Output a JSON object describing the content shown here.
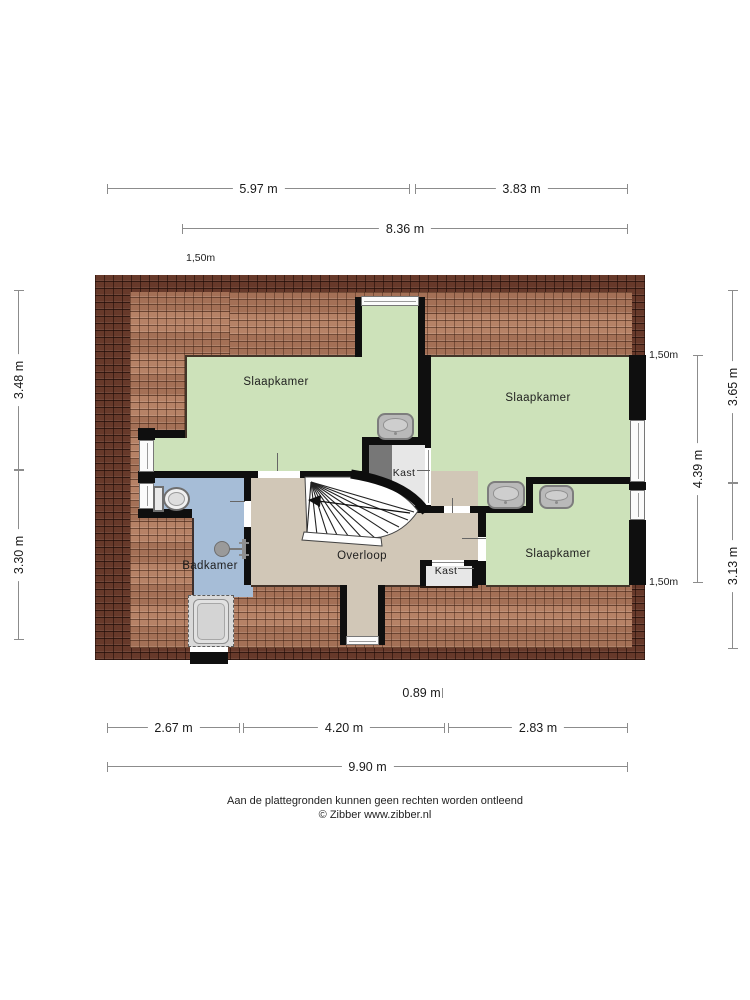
{
  "floorplan": {
    "rooms": [
      {
        "id": "slaapkamer-1",
        "label": "Slaapkamer"
      },
      {
        "id": "slaapkamer-2",
        "label": "Slaapkamer"
      },
      {
        "id": "slaapkamer-3",
        "label": "Slaapkamer"
      },
      {
        "id": "badkamer",
        "label": "Badkamer"
      },
      {
        "id": "overloop",
        "label": "Overloop"
      },
      {
        "id": "kast-1",
        "label": "Kast"
      },
      {
        "id": "kast-2",
        "label": "Kast"
      }
    ],
    "fixtures": [
      "sink",
      "sink",
      "sink",
      "toilet",
      "shower",
      "bathtub",
      "stairs"
    ],
    "height_markers": [
      "1,50m",
      "1,50m",
      "1,50m"
    ],
    "dimensions": {
      "top": [
        "5.97 m",
        "3.83 m",
        "8.36 m"
      ],
      "left": [
        "3.48 m",
        "3.30 m"
      ],
      "right": [
        "3.65 m",
        "4.39 m",
        "3.13 m"
      ],
      "bottom": [
        "0.89 m",
        "2.67 m",
        "4.20 m",
        "2.83 m",
        "9.90 m"
      ]
    },
    "colors": {
      "room_green": "#cde2ba",
      "bathroom_blue": "#a6bdd7",
      "hall_tan": "#d1c7b7",
      "closet_light": "#e7e7e7",
      "closet_dark": "#777777",
      "wall_black": "#0f0f0f",
      "roof_dark": "#67392a",
      "roof_light": "#b27a5d"
    }
  },
  "footer": {
    "disclaimer": "Aan de plattegronden kunnen geen rechten worden ontleend",
    "credit": "© Zibber www.zibber.nl"
  }
}
